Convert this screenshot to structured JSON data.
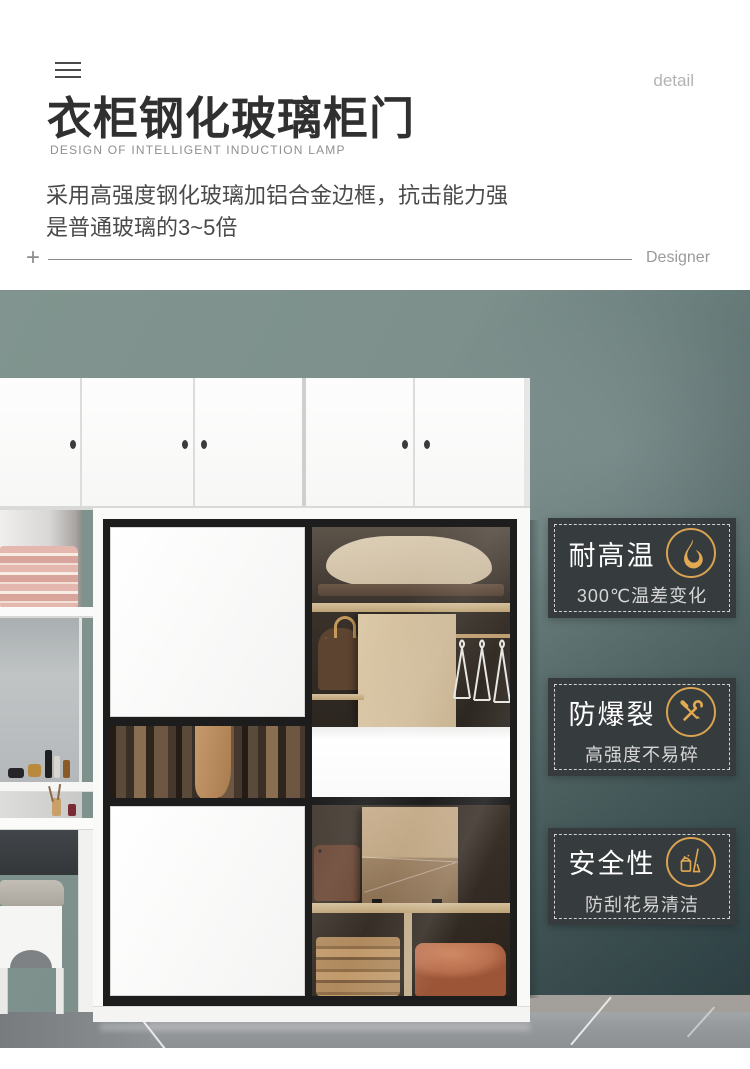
{
  "header": {
    "menu_icon": "hamburger-menu",
    "corner_label": "detail",
    "title": "衣柜钢化玻璃柜门",
    "subtitle": "DESIGN OF INTELLIGENT INDUCTION LAMP",
    "description_line1": "采用高强度钢化玻璃加铝合金边框，抗击能力强",
    "description_line2": "是普通玻璃的3~5倍",
    "divider": {
      "plus": "+",
      "right_label": "Designer"
    }
  },
  "photo": {
    "subject": "white wardrobe with tempered glass sliding doors, top cabinets, vanity with mirror and stool, teal wall, gray tile floor",
    "badges": [
      {
        "title": "耐高温",
        "subtitle": "300℃温差变化",
        "icon": "flame-icon"
      },
      {
        "title": "防爆裂",
        "subtitle": "高强度不易碎",
        "icon": "tools-icon"
      },
      {
        "title": "安全性",
        "subtitle": "防刮花易清洁",
        "icon": "cleaning-icon"
      }
    ],
    "colors": {
      "accent_gold": "#d9a352",
      "badge_bg": "#363b3d",
      "wall_teal": "#7d908c",
      "wall_dark": "#43565a",
      "floor_gray": "#9a9da0"
    }
  }
}
